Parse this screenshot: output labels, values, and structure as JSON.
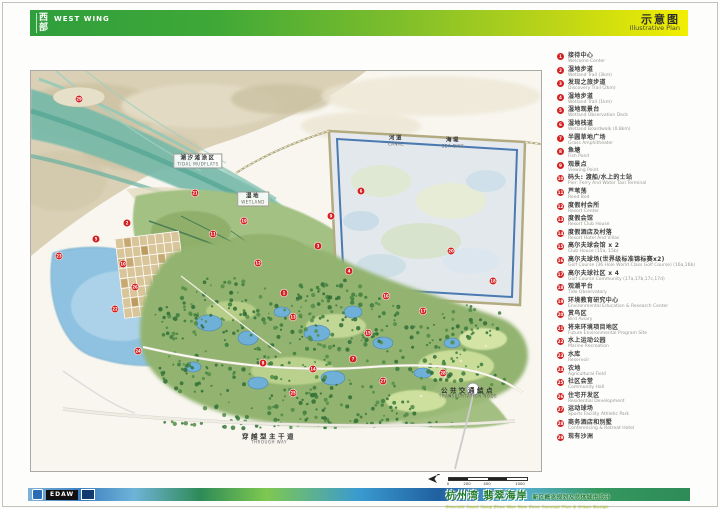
{
  "header": {
    "region_cn": "西部",
    "region_en": "WEST WING",
    "title_cn": "示意图",
    "title_en": "Illustrative Plan"
  },
  "legend": {
    "items": [
      {
        "num": "1",
        "cn": "接待中心",
        "en": "Welcome Center"
      },
      {
        "num": "2",
        "cn": "湿地步道",
        "en": "Wetland Trail (3km)"
      },
      {
        "num": "3",
        "cn": "发现之旅步道",
        "en": "Discovery Trail (2km)"
      },
      {
        "num": "4",
        "cn": "湿地步道",
        "en": "Wetland Trail (1km)"
      },
      {
        "num": "5",
        "cn": "湿地观景台",
        "en": "Wetland Observation Deck"
      },
      {
        "num": "6",
        "cn": "湿地栈道",
        "en": "Wetland Boardwalk (0.8km)"
      },
      {
        "num": "7",
        "cn": "半圆草地广场",
        "en": "Grass Amphitheater"
      },
      {
        "num": "8",
        "cn": "鱼塘",
        "en": "Fish Pond"
      },
      {
        "num": "9",
        "cn": "观景点",
        "en": "Viewing Point"
      },
      {
        "num": "10",
        "cn": "码头: 渡船/水上的士站",
        "en": "Pier: Ferry And Water Taxi Terminal"
      },
      {
        "num": "11",
        "cn": "芦苇荡",
        "en": "Reed Bed"
      },
      {
        "num": "12",
        "cn": "度假村会所",
        "en": "Resort Center"
      },
      {
        "num": "13",
        "cn": "度假会馆",
        "en": "Resort Club House"
      },
      {
        "num": "14",
        "cn": "度假酒店及村落",
        "en": "Resort Hotel And Villas"
      },
      {
        "num": "15",
        "cn": "高尔夫球会馆 x 2",
        "en": "Club House (15a, 15b)"
      },
      {
        "num": "16",
        "cn": "高尔夫球场(世界级标准锦标赛x2)",
        "en": "Golf Course (36 Hole World Class Golf Course) (16a,16b)"
      },
      {
        "num": "17",
        "cn": "高尔夫球社区 x 4",
        "en": "Golf Course Community (17a,17b,17c,17d)"
      },
      {
        "num": "18",
        "cn": "观潮平台",
        "en": "Tide Observatory"
      },
      {
        "num": "19",
        "cn": "环境教育研究中心",
        "en": "Environmental Education & Research Center"
      },
      {
        "num": "20",
        "cn": "赏鸟区",
        "en": "Bird Aviary"
      },
      {
        "num": "21",
        "cn": "将来环境项目地区",
        "en": "Future Environmental Program Site"
      },
      {
        "num": "22",
        "cn": "水上运动公园",
        "en": "Marine Recreation"
      },
      {
        "num": "23",
        "cn": "水库",
        "en": "Reservoir"
      },
      {
        "num": "24",
        "cn": "农地",
        "en": "Agricultural Field"
      },
      {
        "num": "25",
        "cn": "社区会堂",
        "en": "Community Hall"
      },
      {
        "num": "26",
        "cn": "住宅开发区",
        "en": "Residential Development"
      },
      {
        "num": "27",
        "cn": "运动球场",
        "en": "Sports Facility Athletic Park"
      },
      {
        "num": "28",
        "cn": "商务酒店和别墅",
        "en": "Conferencing & Retreat Hotel"
      },
      {
        "num": "29",
        "cn": "现有沙洲",
        "en": ""
      }
    ]
  },
  "map": {
    "labels": [
      {
        "cn": "潮汐滩涂区",
        "en": "TIDAL MUDFLATS",
        "x": 167,
        "y": 90,
        "boxed": true,
        "big": false
      },
      {
        "cn": "湿地",
        "en": "WETLAND",
        "x": 222,
        "y": 128,
        "boxed": true,
        "big": false
      },
      {
        "cn": "河道",
        "en": "CANAL",
        "x": 365,
        "y": 70,
        "boxed": false,
        "big": false
      },
      {
        "cn": "海堤",
        "en": "SEA DIKE",
        "x": 422,
        "y": 72,
        "boxed": false,
        "big": false
      },
      {
        "cn": "公共交通结点",
        "en": "TRANSPORTATION NODE",
        "x": 437,
        "y": 322,
        "boxed": false,
        "big": true
      },
      {
        "cn": "穿越型主干道",
        "en": "THROUGH WAY",
        "x": 238,
        "y": 368,
        "boxed": false,
        "big": true
      }
    ],
    "markers": [
      {
        "n": "29",
        "x": 48,
        "y": 28
      },
      {
        "n": "2",
        "x": 96,
        "y": 152
      },
      {
        "n": "5",
        "x": 65,
        "y": 168
      },
      {
        "n": "23",
        "x": 28,
        "y": 185
      },
      {
        "n": "10",
        "x": 92,
        "y": 193
      },
      {
        "n": "26",
        "x": 104,
        "y": 216
      },
      {
        "n": "22",
        "x": 84,
        "y": 238
      },
      {
        "n": "24",
        "x": 107,
        "y": 280
      },
      {
        "n": "21",
        "x": 164,
        "y": 122
      },
      {
        "n": "11",
        "x": 182,
        "y": 163
      },
      {
        "n": "19",
        "x": 213,
        "y": 150
      },
      {
        "n": "12",
        "x": 227,
        "y": 192
      },
      {
        "n": "1",
        "x": 253,
        "y": 222
      },
      {
        "n": "13",
        "x": 262,
        "y": 246
      },
      {
        "n": "3",
        "x": 287,
        "y": 175
      },
      {
        "n": "9",
        "x": 300,
        "y": 145
      },
      {
        "n": "6",
        "x": 330,
        "y": 120
      },
      {
        "n": "4",
        "x": 318,
        "y": 200
      },
      {
        "n": "16",
        "x": 355,
        "y": 225
      },
      {
        "n": "15",
        "x": 337,
        "y": 262
      },
      {
        "n": "17",
        "x": 392,
        "y": 240
      },
      {
        "n": "20",
        "x": 420,
        "y": 180
      },
      {
        "n": "18",
        "x": 462,
        "y": 210
      },
      {
        "n": "8",
        "x": 232,
        "y": 292
      },
      {
        "n": "14",
        "x": 282,
        "y": 298
      },
      {
        "n": "7",
        "x": 322,
        "y": 288
      },
      {
        "n": "25",
        "x": 262,
        "y": 322
      },
      {
        "n": "27",
        "x": 352,
        "y": 310
      },
      {
        "n": "28",
        "x": 412,
        "y": 302
      }
    ],
    "scale_ticks": [
      {
        "label": "0",
        "x": 0
      },
      {
        "label": "200",
        "x": 19
      },
      {
        "label": "400",
        "x": 39
      },
      {
        "label": "1000 m",
        "x": 72
      }
    ]
  },
  "footer": {
    "edaw": "EDAW",
    "title_cn": "杭州湾 翡翠海岸",
    "title_sub_cn": "新区概念规划及总体城市设计",
    "title_en": "Emerald Coast Hang Zhou Wan New Zone Concept Plan & Urban Design"
  }
}
